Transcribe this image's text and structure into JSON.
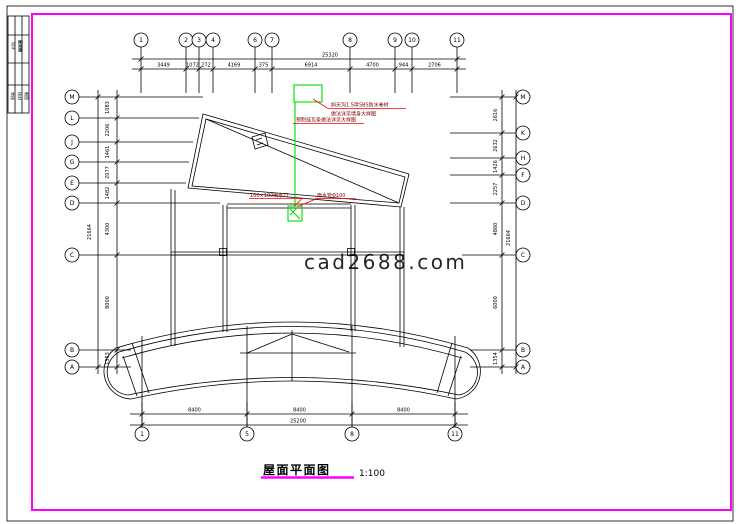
{
  "colors": {
    "frame": "#ff00ff",
    "line": "#000000",
    "green": "#00dd00",
    "red": "#ff0000",
    "annotation_text": "#7a0000",
    "watermark": "#c8c8c8"
  },
  "watermark": {
    "text": "cad2688.com"
  },
  "title": {
    "text": "屋面平面图",
    "scale": "1:100"
  },
  "annotations": [
    {
      "text": "斜天沟1.5厚SBS防水卷材"
    },
    {
      "text": "做法详见墙身大样图"
    },
    {
      "text": "预制挂瓦条做法详见大样图"
    },
    {
      "text": "100×100雨水口"
    },
    {
      "text": "雨水管Φ100"
    }
  ],
  "title_block": {
    "cells": [
      {
        "x": 12,
        "y": 42,
        "text": "设计",
        "bold": false
      },
      {
        "x": 19,
        "y": 40,
        "text": "屋面图",
        "bold": true
      },
      {
        "x": 11,
        "y": 92,
        "text": "审核",
        "bold": false
      },
      {
        "x": 18,
        "y": 92,
        "text": "校对",
        "bold": false
      },
      {
        "x": 25,
        "y": 92,
        "text": "制图",
        "bold": false
      }
    ]
  },
  "axes": {
    "top": {
      "cy": 40,
      "r": 7,
      "v1": 47,
      "v2": 93,
      "circles": [
        {
          "label": "1",
          "x": 141
        },
        {
          "label": "2",
          "x": 186
        },
        {
          "label": "3",
          "x": 199
        },
        {
          "label": "4",
          "x": 213
        },
        {
          "label": "6",
          "x": 255
        },
        {
          "label": "7",
          "x": 272
        },
        {
          "label": "8",
          "x": 350
        },
        {
          "label": "9",
          "x": 395
        },
        {
          "label": "10",
          "x": 412
        },
        {
          "label": "11",
          "x": 457
        }
      ]
    },
    "bottom": {
      "cy": 434,
      "r": 7,
      "v1": 402,
      "v2": 427,
      "circles": [
        {
          "label": "1",
          "x": 142
        },
        {
          "label": "5",
          "x": 247
        },
        {
          "label": "8",
          "x": 352
        },
        {
          "label": "11",
          "x": 455
        }
      ]
    },
    "left": {
      "cx": 72,
      "r": 7,
      "circles": [
        {
          "label": "M",
          "y": 97,
          "stub": 203
        },
        {
          "label": "L",
          "y": 118,
          "stub": 199
        },
        {
          "label": "J",
          "y": 142,
          "stub": 193
        },
        {
          "label": "G",
          "y": 162,
          "stub": 189
        },
        {
          "label": "E",
          "y": 183,
          "stub": 186
        },
        {
          "label": "D",
          "y": 203,
          "stub": 220
        },
        {
          "label": "C",
          "y": 255,
          "stub": 222
        },
        {
          "label": "B",
          "y": 350,
          "stub": 131
        },
        {
          "label": "A",
          "y": 367,
          "stub": 131
        }
      ]
    },
    "right": {
      "cx": 523,
      "r": 7,
      "circles": [
        {
          "label": "M",
          "y": 97,
          "stub": 450
        },
        {
          "label": "K",
          "y": 133,
          "stub": 450
        },
        {
          "label": "H",
          "y": 158,
          "stub": 450
        },
        {
          "label": "F",
          "y": 175,
          "stub": 450
        },
        {
          "label": "D",
          "y": 203,
          "stub": 450
        },
        {
          "label": "C",
          "y": 255,
          "stub": 462
        },
        {
          "label": "B",
          "y": 350,
          "stub": 470
        },
        {
          "label": "A",
          "y": 367,
          "stub": 470
        }
      ]
    }
  },
  "dim_chains": [
    {
      "o": "h",
      "y": 59,
      "x1": 132,
      "x2": 466,
      "ticks": [
        141,
        457
      ],
      "labels": [
        {
          "t": "25320",
          "x": 330,
          "y": 56.5
        }
      ]
    },
    {
      "o": "h",
      "y": 69,
      "x1": 132,
      "x2": 466,
      "ticks": [
        141,
        186,
        199,
        213,
        255,
        272,
        350,
        395,
        412,
        457
      ],
      "labels": [
        {
          "t": "3449",
          "x": 163.5,
          "y": 66.5
        },
        {
          "t": "1072",
          "x": 192.5,
          "y": 66.5
        },
        {
          "t": "272",
          "x": 206,
          "y": 66.5
        },
        {
          "t": "4169",
          "x": 234,
          "y": 66.5
        },
        {
          "t": "375",
          "x": 263.5,
          "y": 66.5
        },
        {
          "t": "6914",
          "x": 311,
          "y": 66.5
        },
        {
          "t": "4700",
          "x": 372.5,
          "y": 66.5
        },
        {
          "t": "944",
          "x": 403.5,
          "y": 66.5
        },
        {
          "t": "2706",
          "x": 434.5,
          "y": 66.5
        }
      ]
    },
    {
      "o": "h",
      "y": 414,
      "x1": 130,
      "x2": 468,
      "ticks": [
        142,
        247,
        352,
        455
      ],
      "labels": [
        {
          "t": "8400",
          "x": 194.5,
          "y": 411.5
        },
        {
          "t": "8400",
          "x": 299.5,
          "y": 411.5
        },
        {
          "t": "8400",
          "x": 403.5,
          "y": 411.5
        }
      ]
    },
    {
      "o": "h",
      "y": 425,
      "x1": 130,
      "x2": 468,
      "ticks": [
        142,
        455
      ],
      "labels": [
        {
          "t": "25200",
          "x": 298,
          "y": 422.5
        }
      ]
    },
    {
      "o": "v",
      "x": 98,
      "y1": 90,
      "y2": 374,
      "ticks": [
        97,
        367
      ],
      "labels": [
        {
          "t": "21664",
          "x": 91,
          "y": 232,
          "rot": true
        }
      ]
    },
    {
      "o": "v",
      "x": 117,
      "y1": 90,
      "y2": 374,
      "ticks": [
        97,
        118,
        142,
        162,
        183,
        203,
        255,
        350,
        367
      ],
      "labels": [
        {
          "t": "1083",
          "x": 109,
          "y": 107.5,
          "rot": true
        },
        {
          "t": "2206",
          "x": 109,
          "y": 130,
          "rot": true
        },
        {
          "t": "1461",
          "x": 109,
          "y": 152,
          "rot": true
        },
        {
          "t": "2077",
          "x": 109,
          "y": 172.5,
          "rot": true
        },
        {
          "t": "1482",
          "x": 109,
          "y": 193,
          "rot": true
        },
        {
          "t": "4300",
          "x": 109,
          "y": 229,
          "rot": true
        },
        {
          "t": "8000",
          "x": 109,
          "y": 302.5,
          "rot": true
        },
        {
          "t": "1353",
          "x": 109,
          "y": 358.5,
          "rot": true
        }
      ]
    },
    {
      "o": "v",
      "x": 502,
      "y1": 90,
      "y2": 374,
      "ticks": [
        97,
        133,
        158,
        175,
        203,
        255,
        350,
        367
      ],
      "labels": [
        {
          "t": "2616",
          "x": 497,
          "y": 115,
          "rot": true
        },
        {
          "t": "2632",
          "x": 497,
          "y": 145.5,
          "rot": true
        },
        {
          "t": "1426",
          "x": 497,
          "y": 166.5,
          "rot": true
        },
        {
          "t": "2257",
          "x": 497,
          "y": 189,
          "rot": true
        },
        {
          "t": "4860",
          "x": 497,
          "y": 229,
          "rot": true
        },
        {
          "t": "6000",
          "x": 497,
          "y": 302.5,
          "rot": true
        },
        {
          "t": "1354",
          "x": 497,
          "y": 358.5,
          "rot": true
        }
      ]
    },
    {
      "o": "v",
      "x": 516,
      "y1": 90,
      "y2": 374,
      "ticks": [
        97,
        367
      ],
      "labels": [
        {
          "t": "21664",
          "x": 510,
          "y": 238,
          "rot": true
        }
      ]
    }
  ]
}
